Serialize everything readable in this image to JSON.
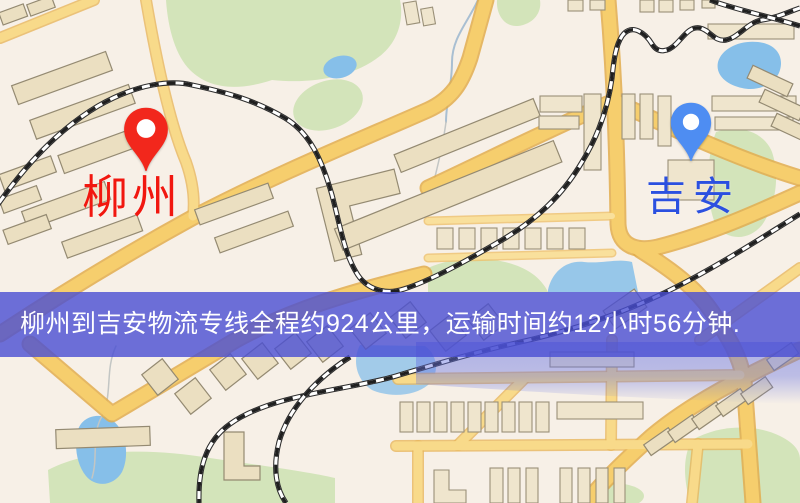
{
  "map": {
    "origin": {
      "label": "柳州",
      "pin_color": "#f2271c",
      "label_color": "#f1170f"
    },
    "destination": {
      "label": "吉安",
      "pin_color": "#4e8df2",
      "label_color": "#2b50e0"
    },
    "features": {
      "road_color": "#f6ce6d",
      "park_color": "#d3e4ba",
      "water_color": "#86bfe9",
      "railway_color": "#2d2d2d"
    }
  },
  "banner": {
    "text": "柳州到吉安物流专线全程约924公里，运输时间约12小时56分钟.",
    "bg_color": "#4d53d6",
    "text_color": "#ffffff"
  }
}
